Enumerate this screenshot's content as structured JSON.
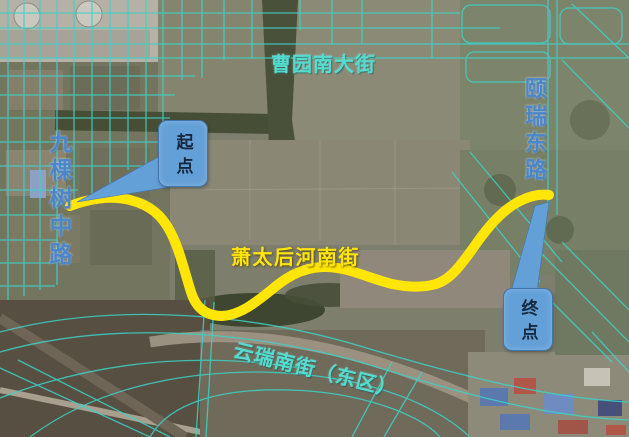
{
  "map": {
    "title": "satellite route map",
    "street_labels": {
      "top": "曹园南大街",
      "left": "九棵树中路",
      "right": "颐瑞东路",
      "center": "萧太后河南街",
      "bottom": "云瑞南街（东区）"
    },
    "callouts": {
      "start": "起点",
      "end": "终点"
    },
    "colors": {
      "route_yellow": "#ffe607",
      "road_overlay_cyan": "#3ed2c6",
      "callout_blue": "#64a0d8",
      "road_label_blue": "#4a86c8",
      "street_label_cyan": "#55dcd0",
      "street_label_yellow": "#ffe60a"
    }
  }
}
